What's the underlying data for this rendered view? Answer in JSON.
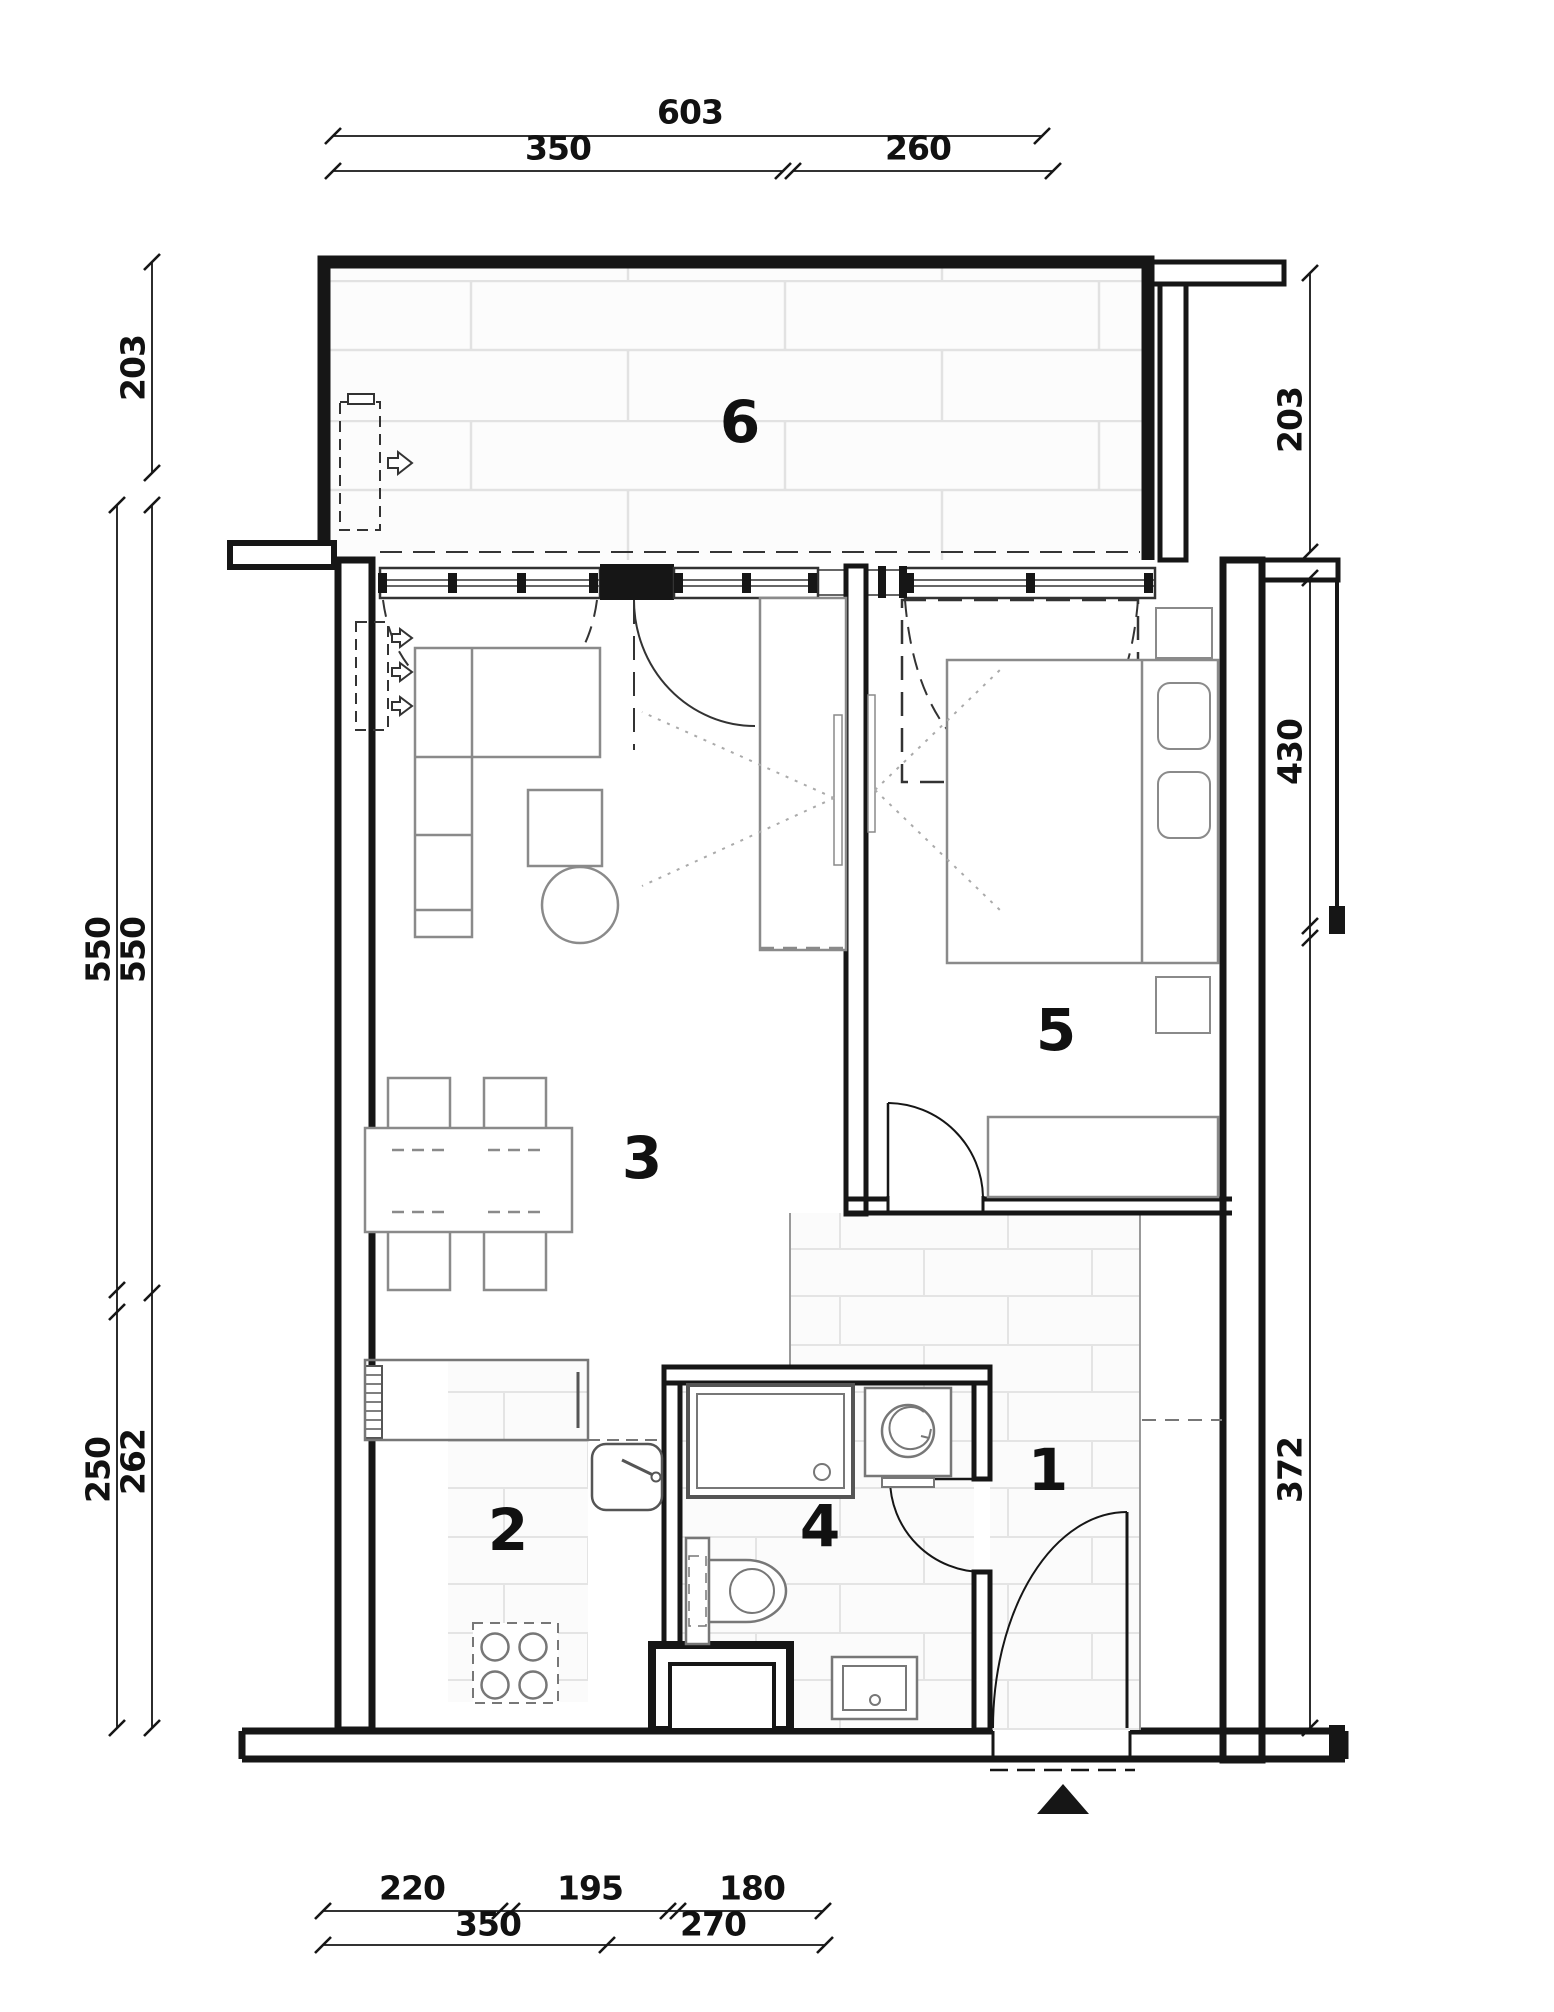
{
  "plan": {
    "type": "apartment-floor-plan",
    "rooms": [
      {
        "label": "1"
      },
      {
        "label": "2"
      },
      {
        "label": "3"
      },
      {
        "label": "4"
      },
      {
        "label": "5"
      },
      {
        "label": "6"
      }
    ],
    "dimensions": {
      "top": {
        "total": "603",
        "row2": [
          "350",
          "260"
        ]
      },
      "bottom": {
        "row1": [
          "220",
          "195",
          "180"
        ],
        "row2": [
          "350",
          "270"
        ]
      },
      "left": {
        "upper": "203",
        "middle": [
          "550",
          "550"
        ],
        "lower": [
          "250",
          "262"
        ]
      },
      "right": {
        "upper": "203",
        "middle": "430",
        "lower": "372"
      }
    },
    "colors": {
      "wall": "#161616",
      "furniture_line": "#8a8a8a",
      "tile_joint": "#e2e2e2",
      "background": "#ffffff"
    },
    "icons": {
      "entrance_marker": "triangle-up",
      "vent_arrow": "arrow-right"
    }
  }
}
